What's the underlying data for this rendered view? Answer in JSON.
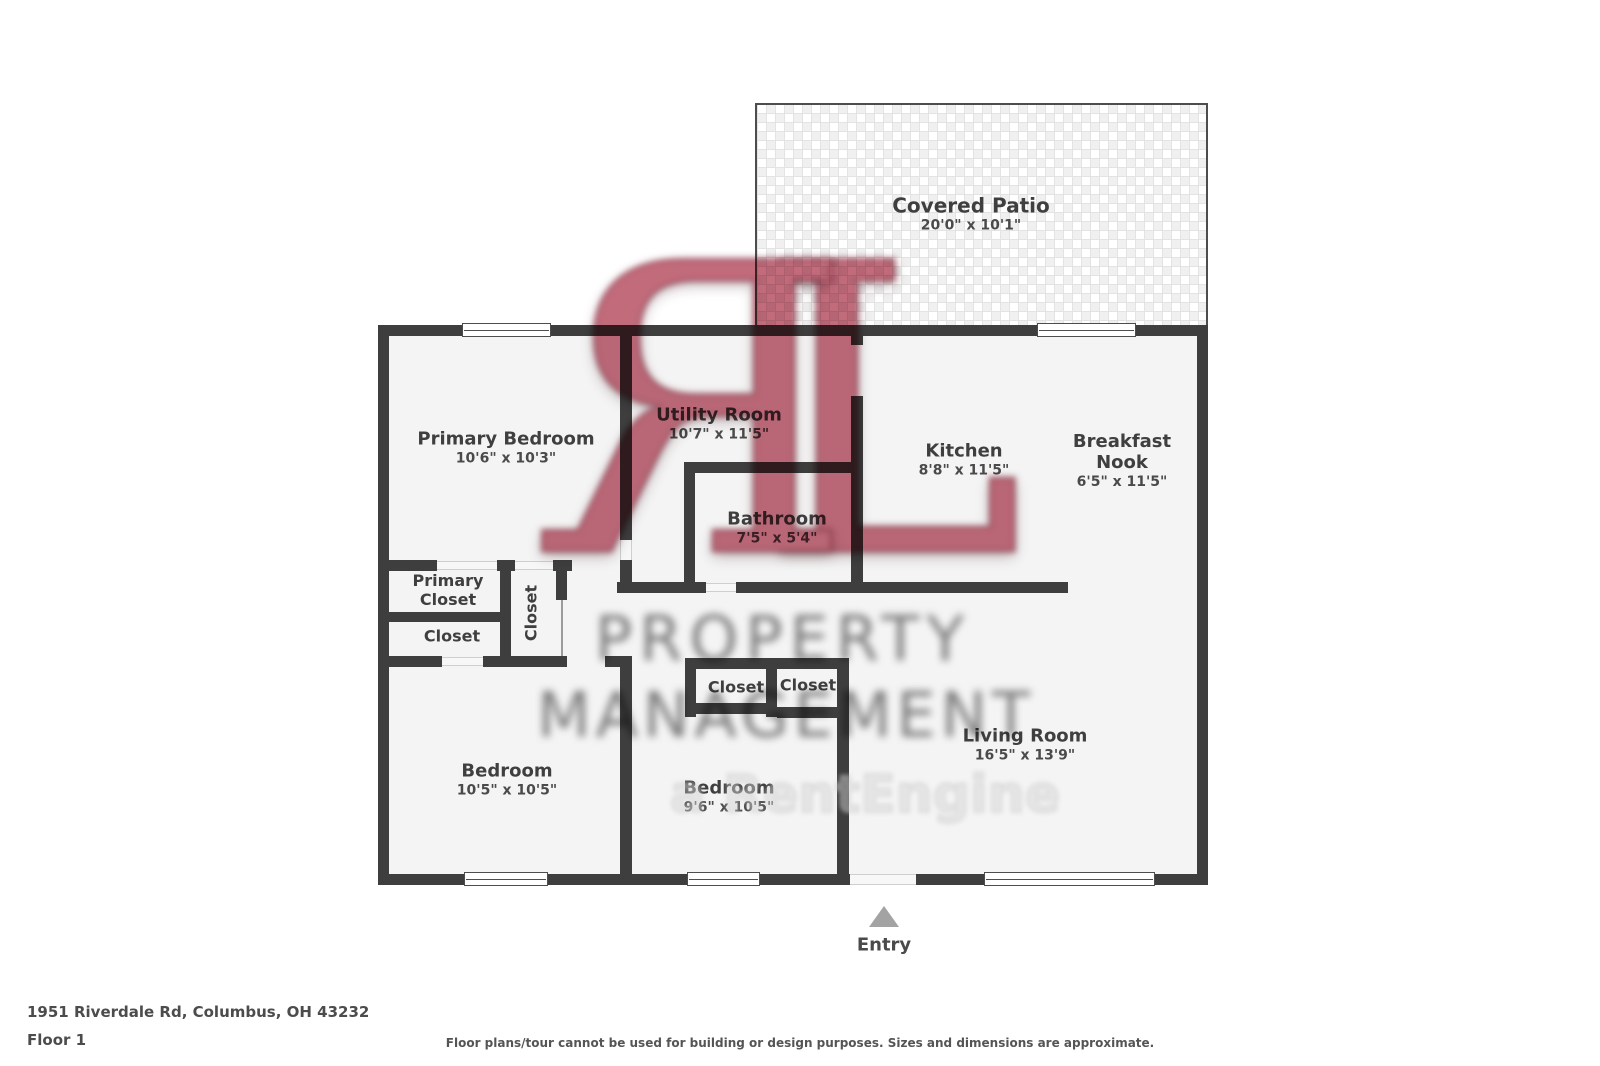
{
  "floorplan": {
    "rooms": {
      "covered_patio": {
        "name": "Covered Patio",
        "dims": "20'0\" x 10'1\""
      },
      "primary_bedroom": {
        "name": "Primary Bedroom",
        "dims": "10'6\" x 10'3\""
      },
      "utility_room": {
        "name": "Utility Room",
        "dims": "10'7\" x 11'5\""
      },
      "kitchen": {
        "name": "Kitchen",
        "dims": "8'8\" x 11'5\""
      },
      "breakfast_nook": {
        "name": "Breakfast Nook",
        "dims": "6'5\" x 11'5\""
      },
      "bathroom": {
        "name": "Bathroom",
        "dims": "7'5\" x 5'4\""
      },
      "living_room": {
        "name": "Living Room",
        "dims": "16'5\" x 13'9\""
      },
      "bedroom_left": {
        "name": "Bedroom",
        "dims": "10'5\" x 10'5\""
      },
      "bedroom_middle": {
        "name": "Bedroom",
        "dims": "9'6\" x 10'5\""
      },
      "primary_closet": {
        "name": "Primary Closet"
      },
      "closet_under_primary": {
        "name": "Closet"
      },
      "closet_hall_vertical": {
        "name": "Closet"
      },
      "closet_middle_left": {
        "name": "Closet"
      },
      "closet_middle_right": {
        "name": "Closet"
      }
    },
    "entry_label": "Entry",
    "wall_color": "#3e3e3e",
    "floor_color": "#f4f4f4"
  },
  "watermark": {
    "logo_left": "R",
    "logo_right": "L",
    "line1": "PROPERTY",
    "line2": "MANAGEMENT",
    "line3": "a RentEngine",
    "accent_color": "#bd5e70",
    "text_color": "#6e6e6e"
  },
  "footer": {
    "address": "1951 Riverdale Rd, Columbus, OH 43232",
    "floor": "Floor 1",
    "disclaimer": "Floor plans/tour cannot be used for building or design purposes. Sizes and dimensions are approximate."
  }
}
